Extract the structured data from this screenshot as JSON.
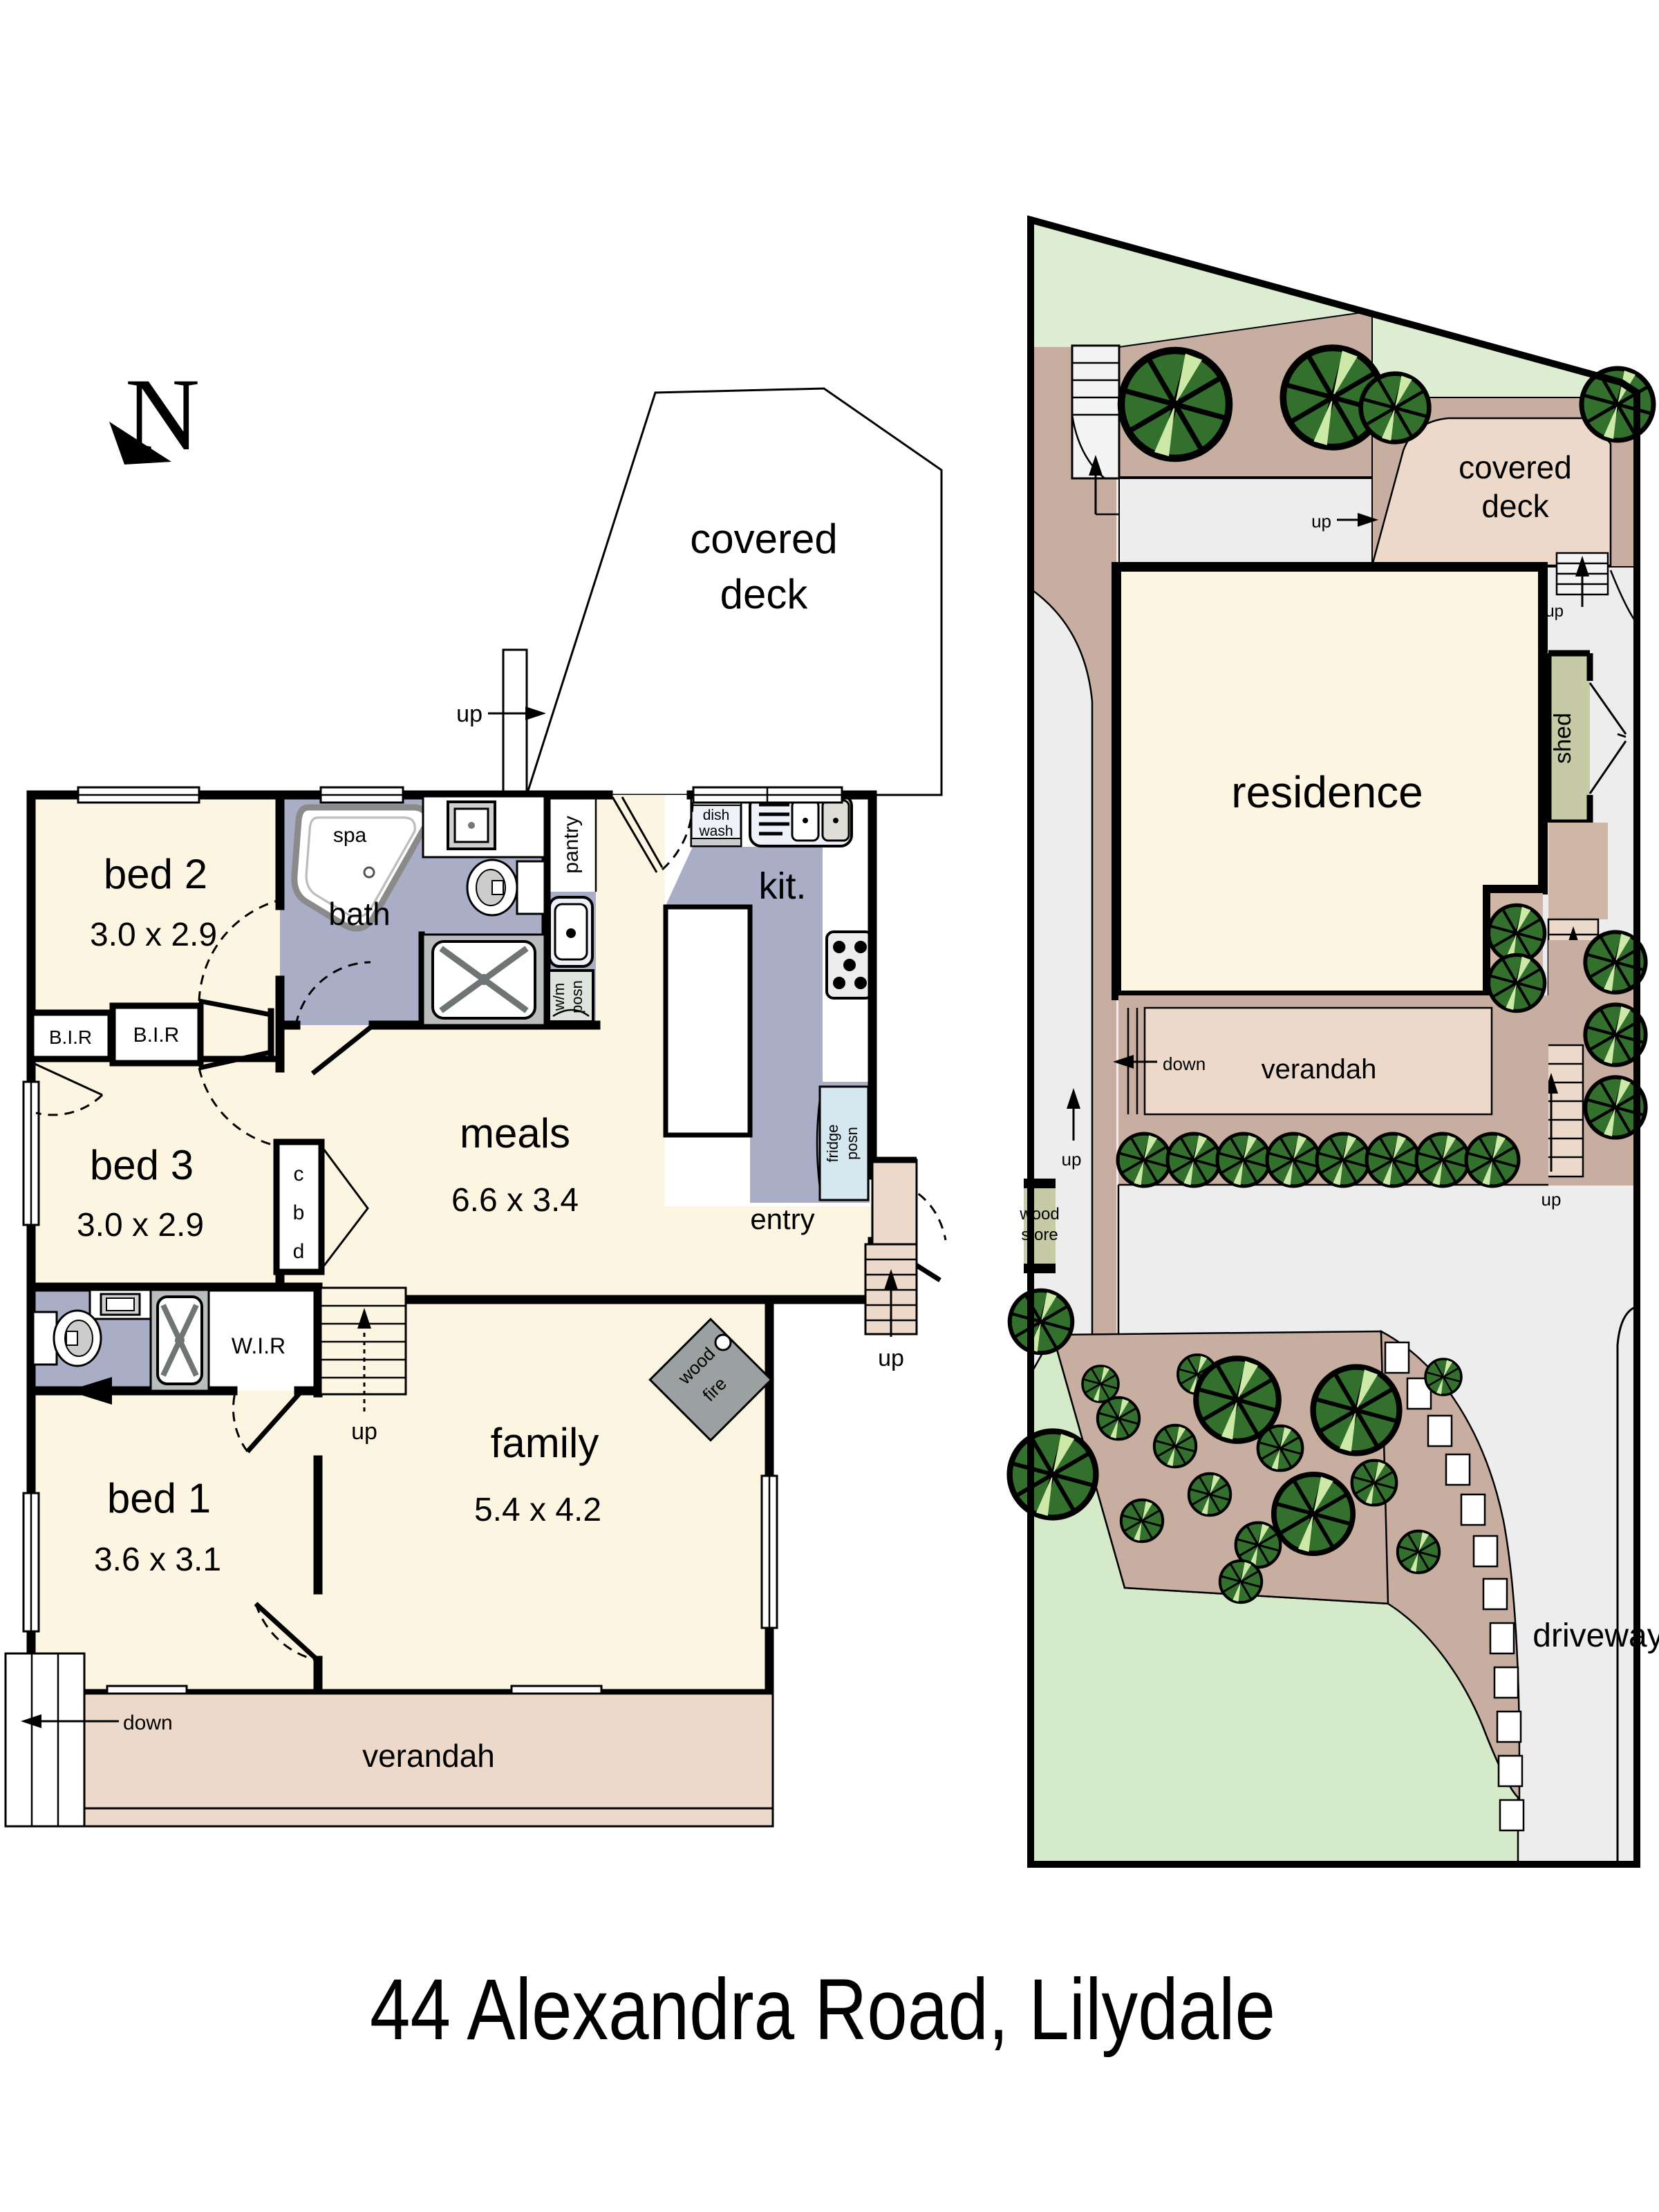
{
  "title": "44 Alexandra Road, Lilydale",
  "compass": {
    "n": "N"
  },
  "floor_plan": {
    "deck_line1": "covered",
    "deck_line2": "deck",
    "deck_up": "up",
    "bed2": "bed 2",
    "bed2_dims": "3.0 x 2.9",
    "bed3": "bed 3",
    "bed3_dims": "3.0 x 2.9",
    "bed1": "bed 1",
    "bed1_dims": "3.6 x 3.1",
    "family": "family",
    "family_dims": "5.4 x 4.2",
    "meals": "meals",
    "meals_dims": "6.6 x 3.4",
    "bath": "bath",
    "spa": "spa",
    "kit": "kit.",
    "pantry": "pantry",
    "wm_line1": "w/m",
    "wm_line2": "posn",
    "dish_line1": "dish",
    "dish_line2": "wash",
    "fridge_line1": "fridge",
    "fridge_line2": "posn",
    "bir_left": "B.I.R",
    "bir_right": "B.I.R",
    "wir": "W.I.R",
    "cbd_c": "c",
    "cbd_b": "b",
    "cbd_d": "d",
    "wood_fire_line1": "wood",
    "wood_fire_line2": "fire",
    "entry": "entry",
    "verandah": "verandah",
    "up_internal": "up",
    "up_entry": "up",
    "down_verandah": "down"
  },
  "site_plan": {
    "residence": "residence",
    "deck_line1": "covered",
    "deck_line2": "deck",
    "shed": "shed",
    "verandah": "verandah",
    "parking": "parking",
    "driveway": "driveway",
    "wood_store_line1": "wood",
    "wood_store_line2": "store",
    "up_left_stair": "up",
    "up_path": "up",
    "up_deck_corner": "up",
    "up_shed_stair": "up",
    "up_right_stair": "up",
    "down_verandah": "down"
  },
  "colors": {
    "wall": "#000000",
    "room_fill": "#fcf5e1",
    "wet_area": "#a9aec6",
    "deck_tan": "#ecd9c9",
    "site_taupe": "#c7aea0",
    "lawn": "#dcedd2",
    "lawn_dark": "#d5eac8",
    "path_gray": "#ededed",
    "tree_green": "#33702e",
    "tree_light": "#cde9a8",
    "olive": "#c6caa5",
    "fridge_blue": "#d5e7ef",
    "fire_gray": "#9ba0a0"
  }
}
